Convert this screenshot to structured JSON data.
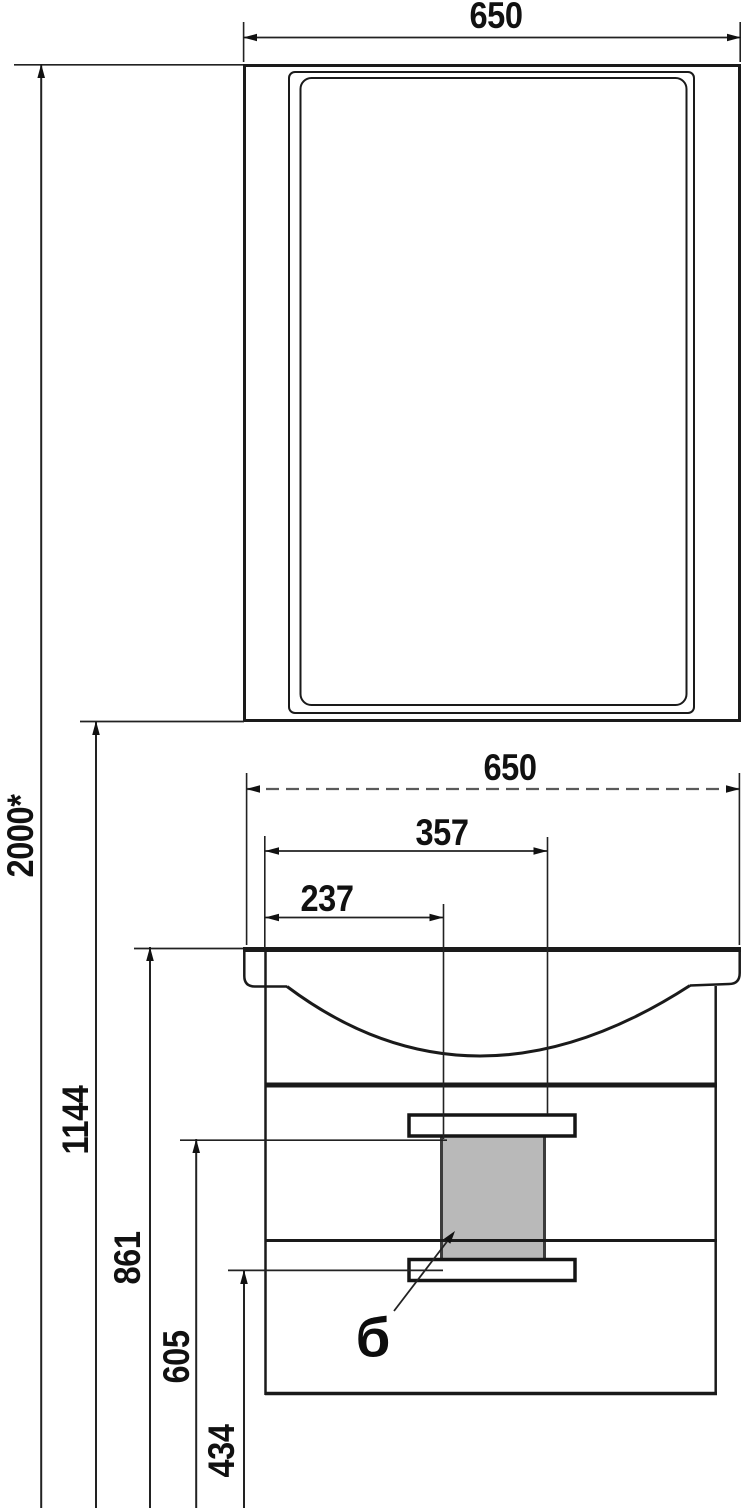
{
  "drawing": {
    "dims": {
      "mirror_width": "650",
      "basin_width": "650",
      "drain_offset_right": "357",
      "drain_offset_left": "237",
      "overall_height": "2000*",
      "mirror_bottom_height": "1144",
      "basin_top_height": "861",
      "siphon_top_height": "605",
      "siphon_bottom_height": "434"
    },
    "callout": {
      "label": "б"
    },
    "colors": {
      "line": "#1a1a1a",
      "dashed_line": "#5a5a5a",
      "siphon_fill": "#b9b9b9",
      "background": "#ffffff"
    }
  }
}
